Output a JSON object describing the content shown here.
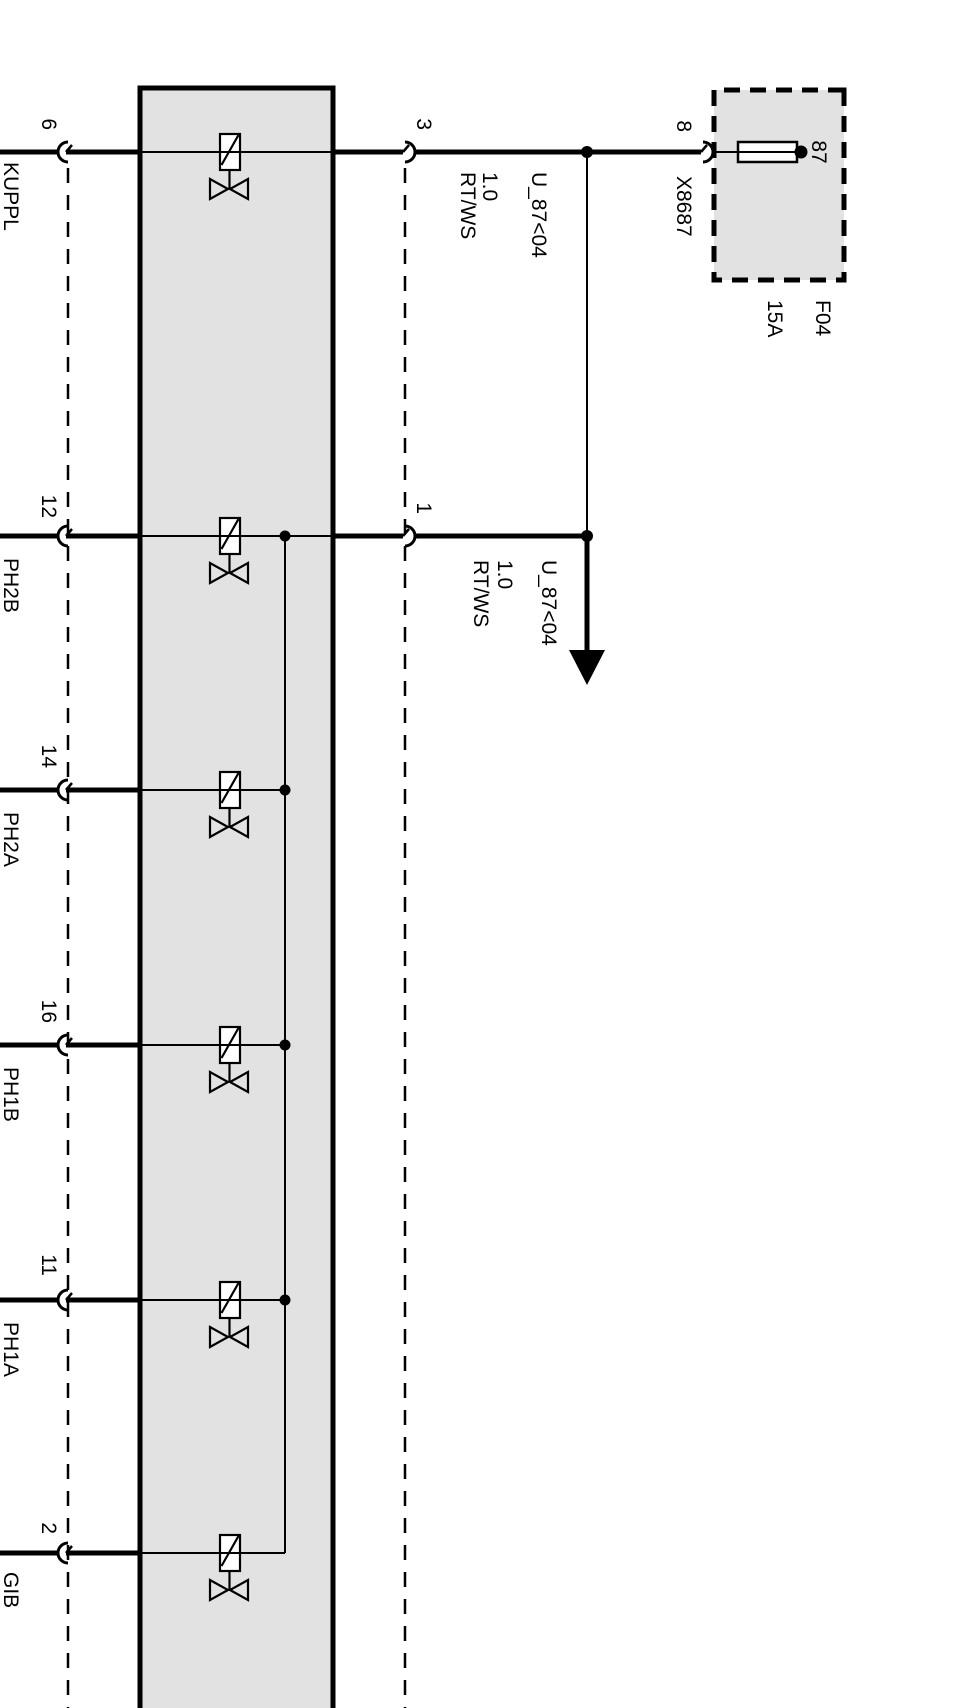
{
  "colors": {
    "background": "#ffffff",
    "box_fill": "#e2e2e2",
    "line": "#000000"
  },
  "fuse": {
    "id": "F04",
    "rating": "15A",
    "terminal": "87"
  },
  "connector": {
    "id": "X8687",
    "pin": "8"
  },
  "supply_pins": [
    {
      "pin": "3"
    },
    {
      "pin": "1"
    }
  ],
  "wire_labels": {
    "supply": {
      "circuit": "U_87<04",
      "gauge": "1.0",
      "color": "RT/WS"
    },
    "branch": {
      "circuit": "U_87<04",
      "gauge": "1.0",
      "color": "RT/WS"
    }
  },
  "outputs": [
    {
      "pin": "6",
      "label": "KUPPL"
    },
    {
      "pin": "12",
      "label": "PH2B"
    },
    {
      "pin": "14",
      "label": "PH2A"
    },
    {
      "pin": "16",
      "label": "PH1B"
    },
    {
      "pin": "11",
      "label": "PH1A"
    },
    {
      "pin": "2",
      "label": "GIB"
    }
  ]
}
